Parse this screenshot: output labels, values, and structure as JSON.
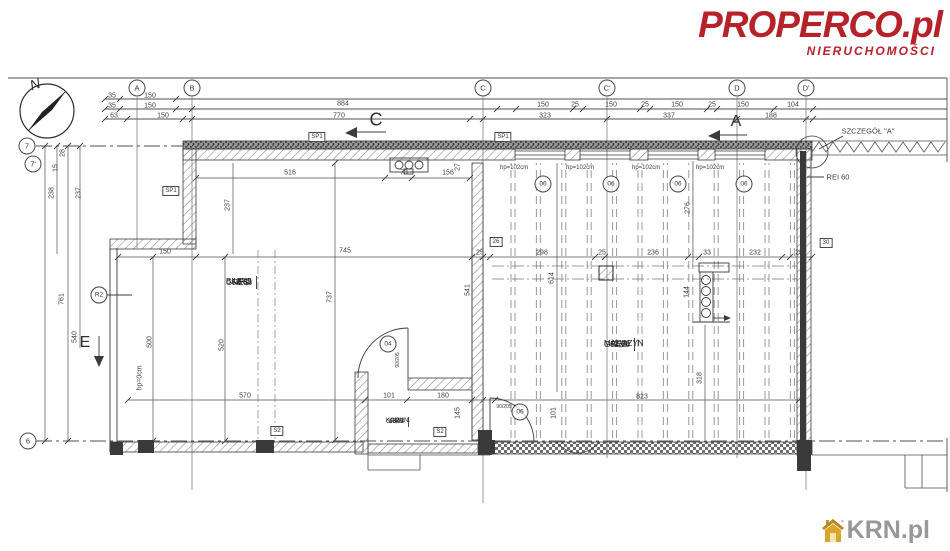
{
  "branding": {
    "properco_name": "PROPERCO.pl",
    "properco_tagline": "NIERUCHOMOŚCI",
    "krn_name": "KRN.pl",
    "properco_color": "#b5222a",
    "krn_gray": "#98989a",
    "krn_gold": "#d8a62a"
  },
  "compass": {
    "north_label": "N"
  },
  "grid_bubbles": {
    "top": [
      {
        "label": "A",
        "x": 137
      },
      {
        "label": "B",
        "x": 192
      },
      {
        "label": "C",
        "x": 483
      },
      {
        "label": "C'",
        "x": 607
      },
      {
        "label": "D",
        "x": 737
      },
      {
        "label": "D'",
        "x": 806
      }
    ],
    "left": [
      {
        "label": "7",
        "x": 27,
        "y": 146
      },
      {
        "label": "7'",
        "x": 33,
        "y": 164
      },
      {
        "label": "6",
        "x": 28,
        "y": 441
      }
    ]
  },
  "section_markers": [
    {
      "label": "C",
      "x": 376,
      "y": 120,
      "fs": 18
    },
    {
      "label": "A",
      "x": 736,
      "y": 122,
      "fs": 16
    },
    {
      "label": "E",
      "x": 85,
      "y": 343,
      "fs": 16
    }
  ],
  "wall_labels": [
    {
      "text": "SZCZEGÓŁ \"A\"",
      "x": 868,
      "y": 131
    },
    {
      "text": "REI 60",
      "x": 838,
      "y": 177
    }
  ],
  "tags": [
    {
      "t": "SP1",
      "x": 171,
      "y": 191
    },
    {
      "t": "SP1",
      "x": 317,
      "y": 137
    },
    {
      "t": "SP1",
      "x": 503,
      "y": 137
    },
    {
      "t": "S2",
      "x": 277,
      "y": 431
    },
    {
      "t": "S2",
      "x": 440,
      "y": 432
    },
    {
      "t": "26",
      "x": 496,
      "y": 242
    },
    {
      "t": "30",
      "x": 826,
      "y": 243
    }
  ],
  "window_markers": [
    {
      "label": "hp=102cm",
      "code": "06",
      "lx": 500,
      "ly": 168,
      "cx": 543,
      "cy": 184
    },
    {
      "label": "hp=102cm",
      "code": "06",
      "lx": 566,
      "ly": 168,
      "cx": 611,
      "cy": 184
    },
    {
      "label": "hp=102cm",
      "code": "06",
      "lx": 632,
      "ly": 168,
      "cx": 678,
      "cy": 184
    },
    {
      "label": "hp=102cm",
      "code": "06",
      "lx": 696,
      "ly": 168,
      "cx": 744,
      "cy": 184
    }
  ],
  "circle_markers": [
    {
      "code": "04",
      "x": 388,
      "y": 344
    },
    {
      "code": "06",
      "x": 520,
      "y": 412
    },
    {
      "code": "R2",
      "x": 99,
      "y": 295
    }
  ],
  "rooms": [
    {
      "number": "2/05",
      "name": "BIURO",
      "area": "56,68",
      "floor": "GRES"
    },
    {
      "number": "2/06",
      "name": "MAGAZYN",
      "area": "62,28",
      "floor": "GRES"
    },
    {
      "number": "2/1",
      "name": "KOMUN.",
      "area": "15,23",
      "floor": "GRES"
    }
  ],
  "dimension_labels": [
    {
      "t": "35",
      "x": 112,
      "y": 96
    },
    {
      "t": "150",
      "x": 150,
      "y": 96
    },
    {
      "t": "35",
      "x": 112,
      "y": 106
    },
    {
      "t": "150",
      "x": 150,
      "y": 106
    },
    {
      "t": "63",
      "x": 114,
      "y": 116
    },
    {
      "t": "150",
      "x": 163,
      "y": 116
    },
    {
      "t": "884",
      "x": 343,
      "y": 104
    },
    {
      "t": "770",
      "x": 339,
      "y": 116
    },
    {
      "t": "150",
      "x": 543,
      "y": 105
    },
    {
      "t": "25",
      "x": 575,
      "y": 105
    },
    {
      "t": "150",
      "x": 611,
      "y": 105
    },
    {
      "t": "25",
      "x": 645,
      "y": 105
    },
    {
      "t": "150",
      "x": 677,
      "y": 105
    },
    {
      "t": "25",
      "x": 712,
      "y": 105
    },
    {
      "t": "150",
      "x": 743,
      "y": 105
    },
    {
      "t": "104",
      "x": 793,
      "y": 105
    },
    {
      "t": "323",
      "x": 545,
      "y": 116
    },
    {
      "t": "337",
      "x": 669,
      "y": 116
    },
    {
      "t": "188",
      "x": 771,
      "y": 116
    },
    {
      "t": "28",
      "x": 63,
      "y": 153,
      "r": 1
    },
    {
      "t": "15",
      "x": 56,
      "y": 168,
      "r": 1
    },
    {
      "t": "238",
      "x": 52,
      "y": 193,
      "r": 1
    },
    {
      "t": "237",
      "x": 79,
      "y": 193,
      "r": 1
    },
    {
      "t": "761",
      "x": 62,
      "y": 299,
      "r": 1
    },
    {
      "t": "540",
      "x": 75,
      "y": 337,
      "r": 1
    },
    {
      "t": "500",
      "x": 150,
      "y": 342,
      "r": 1
    },
    {
      "t": "520",
      "x": 222,
      "y": 345,
      "r": 1
    },
    {
      "t": "hp=0cm",
      "x": 140,
      "y": 378,
      "r": 1
    },
    {
      "t": "516",
      "x": 290,
      "y": 173
    },
    {
      "t": "73",
      "x": 404,
      "y": 173
    },
    {
      "t": "156",
      "x": 448,
      "y": 173
    },
    {
      "t": "27",
      "x": 458,
      "y": 167,
      "r": 1
    },
    {
      "t": "237",
      "x": 228,
      "y": 205,
      "r": 1
    },
    {
      "t": "737",
      "x": 330,
      "y": 297,
      "r": 1
    },
    {
      "t": "150",
      "x": 165,
      "y": 252
    },
    {
      "t": "745",
      "x": 345,
      "y": 251
    },
    {
      "t": "541",
      "x": 468,
      "y": 290,
      "r": 1
    },
    {
      "t": "570",
      "x": 245,
      "y": 396
    },
    {
      "t": "101",
      "x": 389,
      "y": 396
    },
    {
      "t": "180",
      "x": 443,
      "y": 396
    },
    {
      "t": "145",
      "x": 458,
      "y": 413,
      "r": 1
    },
    {
      "t": "25",
      "x": 480,
      "y": 253
    },
    {
      "t": "298",
      "x": 542,
      "y": 253
    },
    {
      "t": "25",
      "x": 602,
      "y": 253
    },
    {
      "t": "236",
      "x": 653,
      "y": 253
    },
    {
      "t": "33",
      "x": 707,
      "y": 253
    },
    {
      "t": "232",
      "x": 755,
      "y": 253
    },
    {
      "t": "25",
      "x": 799,
      "y": 253
    },
    {
      "t": "614",
      "x": 552,
      "y": 278,
      "r": 1
    },
    {
      "t": "276",
      "x": 688,
      "y": 208,
      "r": 1
    },
    {
      "t": "144",
      "x": 687,
      "y": 292,
      "r": 1
    },
    {
      "t": "318",
      "x": 700,
      "y": 378,
      "r": 1
    },
    {
      "t": "823",
      "x": 642,
      "y": 397
    },
    {
      "t": "101",
      "x": 554,
      "y": 413,
      "r": 1
    },
    {
      "t": "90/205",
      "x": 398,
      "y": 360,
      "r": 1,
      "tiny": 1
    },
    {
      "t": "90/205",
      "x": 504,
      "y": 407,
      "tiny": 1
    }
  ]
}
